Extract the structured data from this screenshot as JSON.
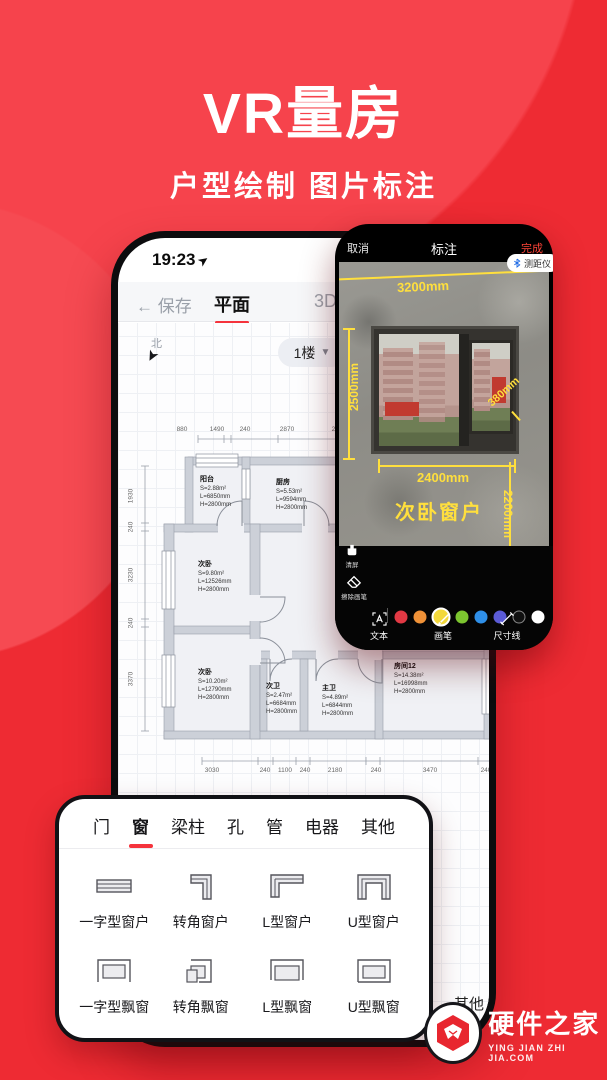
{
  "hero": {
    "title": "VR量房",
    "subtitle": "户型绘制 图片标注"
  },
  "plan_phone": {
    "status_time": "19:23",
    "nav": {
      "back": "保存",
      "tab_plan": "平面",
      "tab_3d": "3D"
    },
    "compass": "北",
    "floor_selector": "1楼",
    "dims_top": [
      "880",
      "1490",
      "240",
      "2870",
      "250"
    ],
    "dims_left": [
      "1930",
      "240",
      "3230",
      "240",
      "3370"
    ],
    "dims_bottom": [
      "3030",
      "240",
      "1100",
      "240",
      "2180",
      "240",
      "3470",
      "240"
    ],
    "rooms": [
      {
        "name": "阳台",
        "s": "S=2.88m²",
        "l": "L=6850mm",
        "h": "H=2800mm"
      },
      {
        "name": "厨房",
        "s": "S=5.53m²",
        "l": "L=9594mm",
        "h": "H=2800mm"
      },
      {
        "name": "次卧",
        "s": "S=9.80m²",
        "l": "L=12526mm",
        "h": "H=2800mm"
      },
      {
        "name": "次卧",
        "s": "S=10.20m²",
        "l": "L=12790mm",
        "h": "H=2800mm"
      },
      {
        "name": "次卫",
        "s": "S=2.47m²",
        "l": "L=6684mm",
        "h": "H=2800mm"
      },
      {
        "name": "主卫",
        "s": "S=4.89m²",
        "l": "L=6844mm",
        "h": "H=2800mm"
      },
      {
        "name": "房间12",
        "s": "S=14.38m²",
        "l": "L=16998mm",
        "h": "H=2800mm"
      }
    ],
    "bottom_bar_partial": [
      "器",
      "其他"
    ]
  },
  "annot_phone": {
    "header": {
      "cancel": "取消",
      "title": "标注",
      "done": "完成"
    },
    "ruler_button": "测距仪",
    "measurements": {
      "top": "3200mm",
      "left": "2500mm",
      "diag": "380mm",
      "width": "2400mm",
      "right": "2200mm",
      "caption": "次卧窗户"
    },
    "toolbar": {
      "clear": "清屏",
      "eraser": "擦除画笔",
      "text": "文本",
      "brush": "画笔",
      "dimension": "尺寸线",
      "palette": [
        "#e23944",
        "#f09238",
        "#f3d83a",
        "#7cc52f",
        "#2f8fe8",
        "#5b5bd6",
        "#101010",
        "#ffffff"
      ],
      "selected_color_index": 2
    },
    "colors": {
      "accent_yellow": "#ffdf3d",
      "done_red": "#ff4438",
      "bluetooth_blue": "#1e6be6"
    }
  },
  "panel": {
    "tabs": [
      "门",
      "窗",
      "梁柱",
      "孔",
      "管",
      "电器",
      "其他"
    ],
    "active_tab": "窗",
    "items": [
      {
        "label": "一字型窗户",
        "icon": "straight-window-icon"
      },
      {
        "label": "转角窗户",
        "icon": "corner-window-icon"
      },
      {
        "label": "L型窗户",
        "icon": "l-window-icon"
      },
      {
        "label": "U型窗户",
        "icon": "u-window-icon"
      },
      {
        "label": "一字型飘窗",
        "icon": "straight-baywindow-icon"
      },
      {
        "label": "转角飘窗",
        "icon": "corner-baywindow-icon"
      },
      {
        "label": "L型飘窗",
        "icon": "l-baywindow-icon"
      },
      {
        "label": "U型飘窗",
        "icon": "u-baywindow-icon"
      }
    ]
  },
  "watermark": {
    "name": "硬件之家",
    "domain": "YING JIAN ZHI JIA.COM"
  },
  "brand_colors": {
    "background_red": "#ee2b33",
    "accent_red": "#f5333c"
  }
}
